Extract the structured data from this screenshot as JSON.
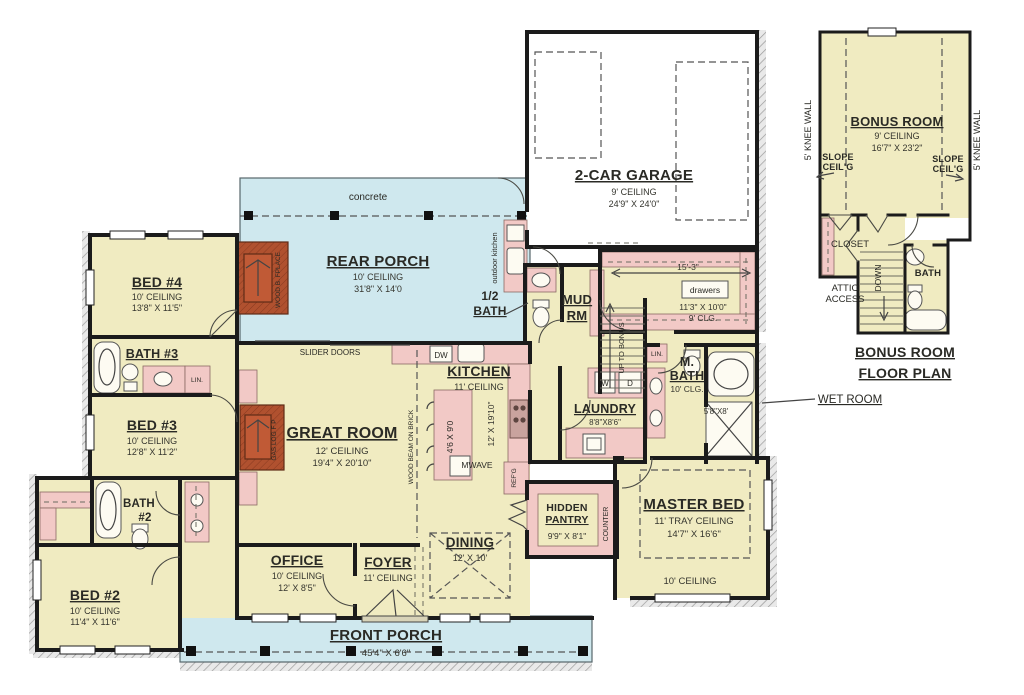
{
  "rooms": {
    "bed4": {
      "name": "BED #4",
      "ceiling": "10' CEILING",
      "dims": "13'8\" X 11'5\""
    },
    "bath3": {
      "name": "BATH #3",
      "linen": "LIN."
    },
    "bed3": {
      "name": "BED #3",
      "ceiling": "10' CEILING",
      "dims": "12'8\" X 11'2\""
    },
    "bath2": {
      "name_line1": "BATH",
      "name_line2": "#2"
    },
    "bed2": {
      "name": "BED #2",
      "ceiling": "10' CEILING",
      "dims": "11'4\" X 11'6\""
    },
    "rear_porch": {
      "name": "REAR PORCH",
      "ceiling": "10' CEILING",
      "dims": "31'8\" X 14'0",
      "concrete": "concrete",
      "outdoor_kitchen": "outdoor kitchen",
      "slider_doors": "SLIDER DOORS",
      "fireplace": "WOOD B. FPLACE"
    },
    "great_room": {
      "name": "GREAT ROOM",
      "ceiling": "12' CEILING",
      "dims": "19'4\" X 20'10\"",
      "fireplace": "GAS LOG F P",
      "beam": "WOOD BEAM ON BRICK"
    },
    "kitchen": {
      "name": "KITCHEN",
      "ceiling": "11' CEILING",
      "dw": "DW",
      "island_dims": "4'6 X 9'0",
      "dims": "12' X 19'10\"",
      "mwave": "MWAVE",
      "refg": "REF'G"
    },
    "garage": {
      "name": "2-CAR GARAGE",
      "ceiling": "9' CEILING",
      "dims": "24'9\" X 24'0\""
    },
    "half_bath": {
      "name_line1": "1/2",
      "name_line2": "BATH"
    },
    "mud_room": {
      "name_line1": "MUD",
      "name_line2": "RM"
    },
    "master_closet": {
      "width_dim": "15'-3\"",
      "drawers": "drawers",
      "dims": "11'3\" X 10'0\"",
      "clg": "9' CLG."
    },
    "stairs": {
      "up": "UP TO BONUS",
      "linen": "LIN."
    },
    "laundry": {
      "name": "LAUNDRY",
      "dims": "8'8\"X8'6\"",
      "washer": "W",
      "dryer": "D"
    },
    "master_bath": {
      "name_line1": "M.",
      "name_line2": "BATH",
      "clg": "10' CLG."
    },
    "wet_room": {
      "dims": "5'8\"X8'",
      "callout": "WET ROOM"
    },
    "master_bed": {
      "name": "MASTER BED",
      "ceiling": "11' TRAY CEILING",
      "dims": "14'7\" X 16'6\"",
      "ceiling2": "10' CEILING"
    },
    "hidden_pantry": {
      "name_line1": "HIDDEN",
      "name_line2": "PANTRY",
      "dims": "9'9\" X 8'1\"",
      "counter": "COUNTER"
    },
    "dining": {
      "name": "DINING",
      "dims": "12' X 10'"
    },
    "office": {
      "name": "OFFICE",
      "ceiling": "10' CEILING",
      "dims": "12' X 8'5\""
    },
    "foyer": {
      "name": "FOYER",
      "ceiling": "11' CEILING"
    },
    "front_porch": {
      "name": "FRONT PORCH",
      "dims": "45'4\" X 6'6\""
    }
  },
  "bonus": {
    "knee_wall_left": "5' KNEE WALL",
    "knee_wall_right": "5' KNEE WALL",
    "name": "BONUS ROOM",
    "ceiling": "9' CEILING",
    "dims": "16'7\" X 23'2\"",
    "slope_line1": "SLOPE",
    "slope_line2": "CEIL'G",
    "closet": "CLOSET",
    "attic_line1": "ATTIC",
    "attic_line2": "ACCESS",
    "down": "DOWN",
    "bath": "BATH",
    "title_line1": "BONUS ROOM",
    "title_line2": "FLOOR PLAN"
  },
  "colors": {
    "wall": "#1b1b1b",
    "room_fill": "#f0ebc1",
    "porch_fill": "#cfe8ee",
    "fixture_fill": "#f2c9c6",
    "fireplace_fill": "#b0512f",
    "firebox_fill": "#8a3a20",
    "garage_fill": "#ffffff"
  }
}
